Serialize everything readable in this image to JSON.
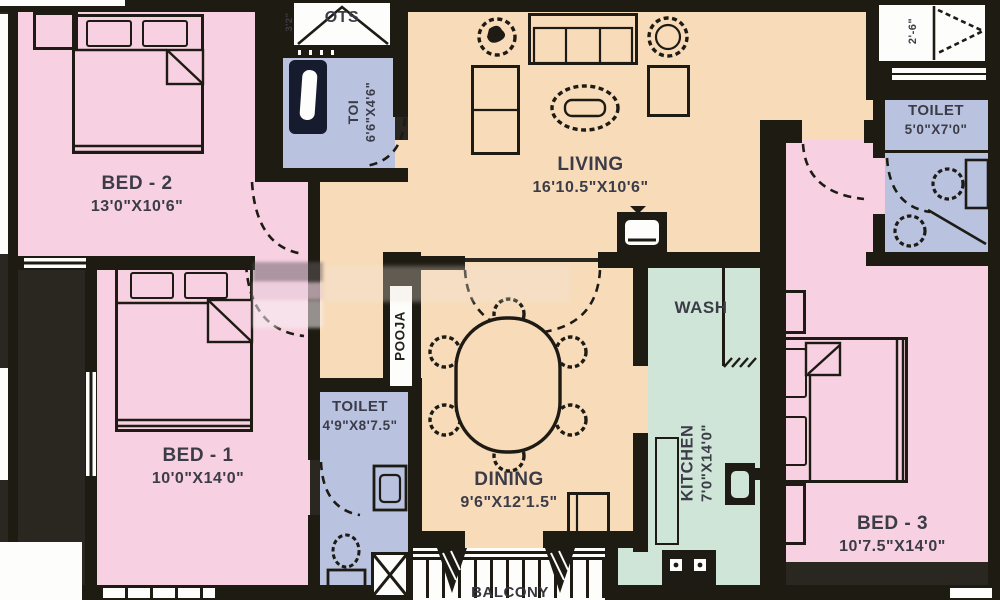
{
  "rooms": {
    "bed2": {
      "name": "BED - 2",
      "dims": "13'0\"X10'6\""
    },
    "bed1": {
      "name": "BED - 1",
      "dims": "10'0\"X14'0\""
    },
    "bed3": {
      "name": "BED - 3",
      "dims": "10'7.5\"X14'0\""
    },
    "living": {
      "name": "LIVING",
      "dims": "16'10.5\"X10'6\""
    },
    "dining": {
      "name": "DINING",
      "dims": "9'6\"X12'1.5\""
    },
    "kitchen": {
      "name": "KITCHEN",
      "dims": "7'0\"X14'0\""
    },
    "wash": {
      "name": "WASH"
    },
    "pooja": {
      "name": "POOJA"
    },
    "balcony": {
      "name": "BALCONY"
    },
    "ots": {
      "name": "OTS"
    },
    "toilet_top": {
      "name": "TOI",
      "dims": "6'6\"X4'6\""
    },
    "toilet_bed3": {
      "name": "TOILET",
      "dims": "5'0\"X7'0\""
    },
    "toilet_bed1": {
      "name": "TOILET",
      "dims": "4'9\"X8'7.5\""
    }
  },
  "annotations": {
    "terrace_depth": "2'-6\"",
    "ots_side": "3'2\""
  },
  "colors": {
    "bedroom_pink": "#f7d1e1",
    "hall_cream": "#f8dcba",
    "toilet_blue": "#b9c3e0",
    "kitchen_mint": "#cfe5d7",
    "wall_dark": "#1e1b13",
    "outer_dark": "#292720",
    "label_text": "#3c3c48",
    "white": "#fdfdfb"
  }
}
